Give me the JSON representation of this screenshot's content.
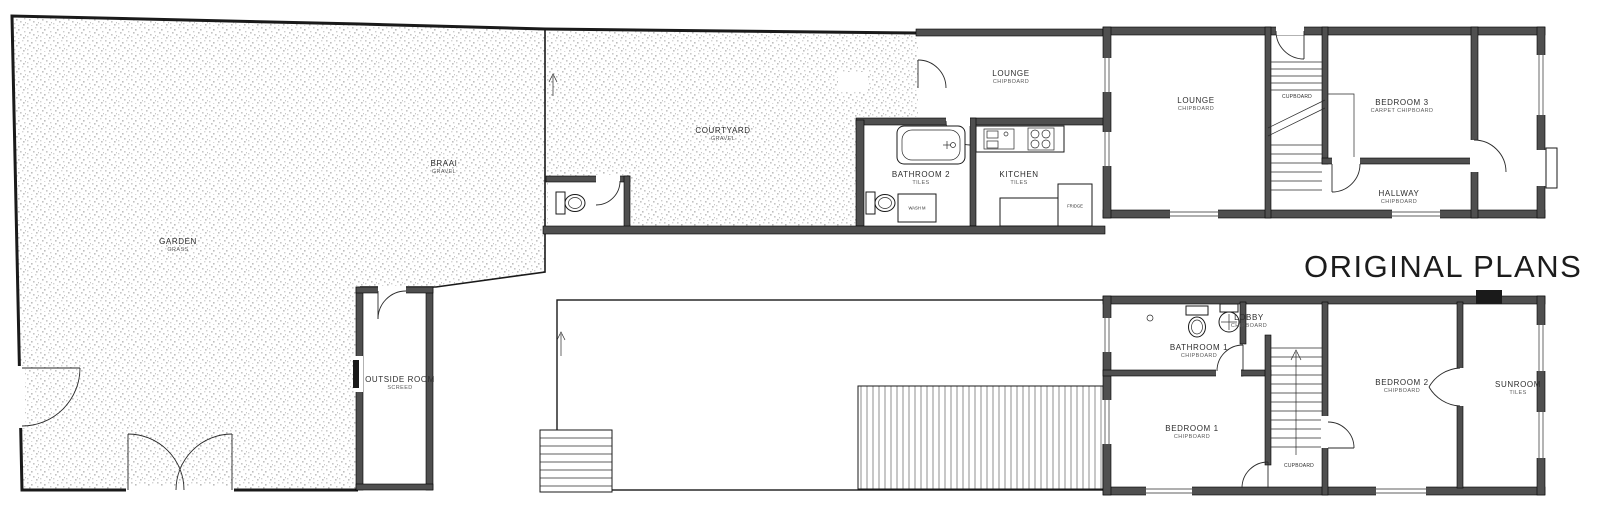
{
  "title": "ORIGINAL PLANS",
  "ground": {
    "garden": {
      "name": "GARDEN",
      "finish": "GRASS"
    },
    "braai": {
      "name": "BRAAI",
      "finish": "GRAVEL"
    },
    "courtyard": {
      "name": "COURTYARD",
      "finish": "GRAVEL"
    },
    "outside_room": {
      "name": "OUTSIDE ROOM",
      "finish": "SCREED"
    },
    "lounge_front": {
      "name": "LOUNGE",
      "finish": "CHIPBOARD"
    },
    "bathroom2": {
      "name": "BATHROOM 2",
      "finish": "TILES"
    },
    "kitchen": {
      "name": "KITCHEN",
      "finish": "TILES"
    },
    "lounge_main": {
      "name": "LOUNGE",
      "finish": "CHIPBOARD"
    },
    "cupboard": {
      "name": "CUPBOARD"
    },
    "bedroom3": {
      "name": "BEDROOM 3",
      "finish": "CARPET CHIPBOARD"
    },
    "hallway": {
      "name": "HALLWAY",
      "finish": "CHIPBOARD"
    },
    "wash_machine": {
      "name": "WASH M"
    },
    "fridge": {
      "name": "FRIDGE"
    }
  },
  "first": {
    "bathroom1": {
      "name": "BATHROOM 1",
      "finish": "CHIPBOARD"
    },
    "lobby": {
      "name": "LOBBY",
      "finish": "CHIPBOARD"
    },
    "bedroom1": {
      "name": "BEDROOM 1",
      "finish": "CHIPBOARD"
    },
    "bedroom2": {
      "name": "BEDROOM 2",
      "finish": "CHIPBOARD"
    },
    "sunroom": {
      "name": "SUNROOM",
      "finish": "TILES"
    },
    "cupboard": {
      "name": "CUPBOARD"
    }
  }
}
